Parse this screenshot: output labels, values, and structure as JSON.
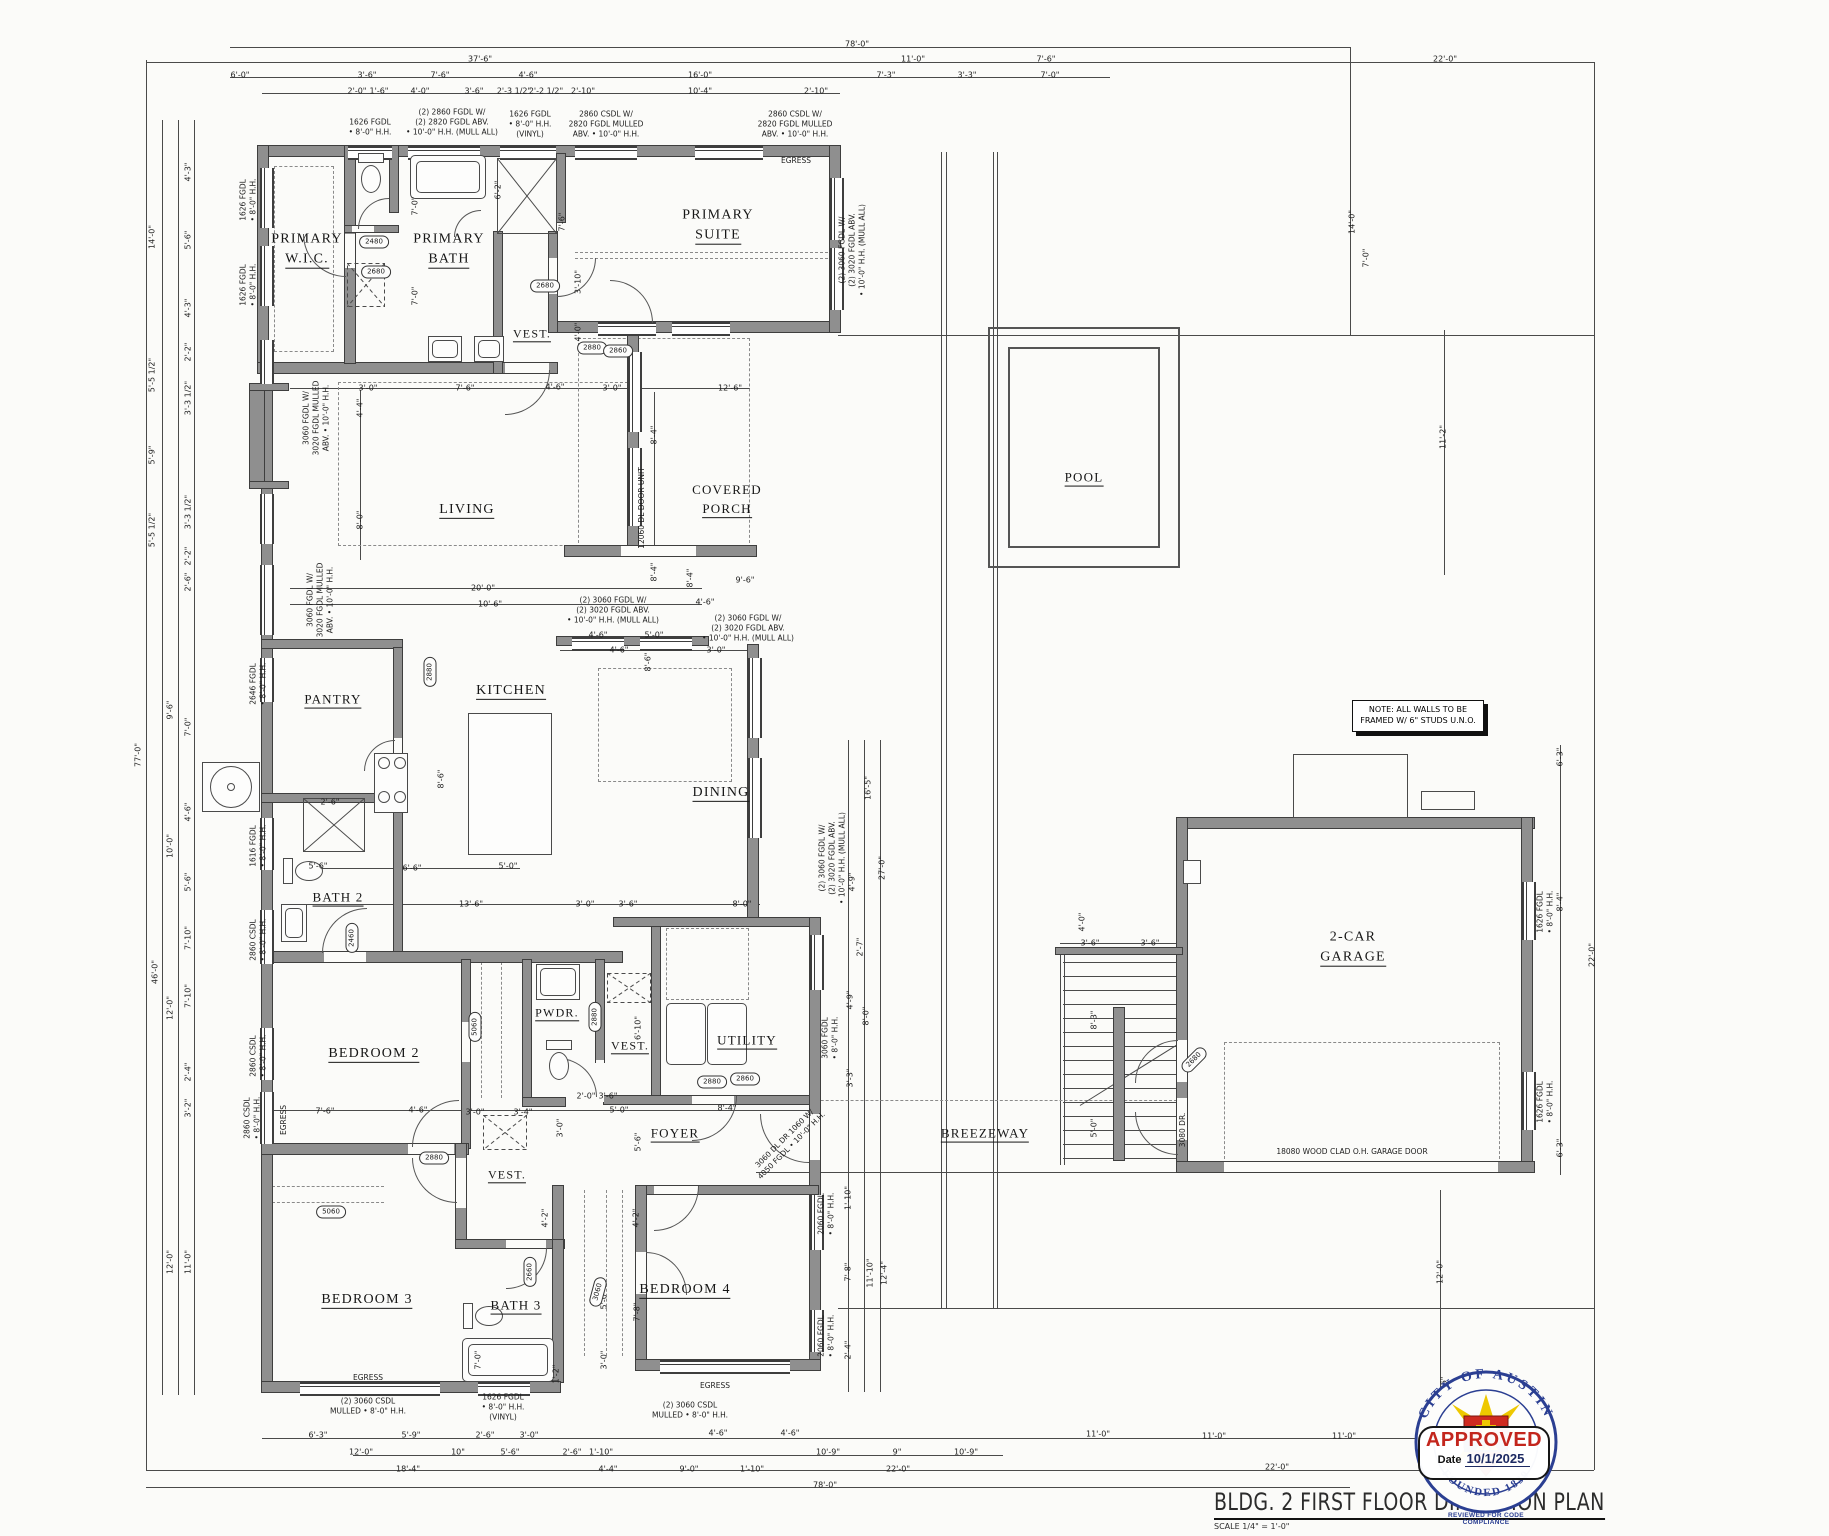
{
  "title_block": {
    "title": "BLDG. 2 FIRST FLOOR DIMENSION PLAN",
    "scale": "SCALE 1/4\" = 1'-0\""
  },
  "stamp": {
    "seal_top": "CITY OF AUSTIN",
    "seal_bottom": "FOUNDED 1839",
    "approved": "APPROVED",
    "date_label": "Date",
    "date": "10/1/2025",
    "reviewed": "REVIEWED FOR CODE COMPLIANCE"
  },
  "note": "NOTE: ALL WALLS TO BE\nFRAMED W/ 6\" STUDS U.N.O.",
  "colors": {
    "wall_gray": "#8f8f8f",
    "approved_red": "#c3261d",
    "seal_blue": "#2b3f92",
    "seal_yellow": "#eec800",
    "seal_red": "#cf2a20"
  },
  "rooms": [
    {
      "id": "primary-wic",
      "lines": [
        "PRIMARY",
        "W.I.C."
      ],
      "x": 307,
      "y": 250,
      "s": 14
    },
    {
      "id": "primary-bath",
      "lines": [
        "PRIMARY",
        "BATH"
      ],
      "x": 449,
      "y": 250,
      "s": 14
    },
    {
      "id": "vest-1",
      "lines": [
        "VEST."
      ],
      "x": 532,
      "y": 334,
      "s": 12
    },
    {
      "id": "primary-suite",
      "lines": [
        "PRIMARY",
        "SUITE"
      ],
      "x": 718,
      "y": 226,
      "s": 14
    },
    {
      "id": "living",
      "lines": [
        "LIVING"
      ],
      "x": 467,
      "y": 510,
      "s": 14
    },
    {
      "id": "covered-porch",
      "lines": [
        "COVERED",
        "PORCH"
      ],
      "x": 727,
      "y": 500,
      "s": 13
    },
    {
      "id": "pool",
      "lines": [
        "POOL"
      ],
      "x": 1084,
      "y": 478,
      "s": 13
    },
    {
      "id": "pantry",
      "lines": [
        "PANTRY"
      ],
      "x": 333,
      "y": 700,
      "s": 13
    },
    {
      "id": "kitchen",
      "lines": [
        "KITCHEN"
      ],
      "x": 511,
      "y": 691,
      "s": 14
    },
    {
      "id": "dining",
      "lines": [
        "DINING"
      ],
      "x": 721,
      "y": 793,
      "s": 14
    },
    {
      "id": "bath-2",
      "lines": [
        "BATH 2"
      ],
      "x": 338,
      "y": 898,
      "s": 13
    },
    {
      "id": "bedroom-2",
      "lines": [
        "BEDROOM 2"
      ],
      "x": 374,
      "y": 1054,
      "s": 14
    },
    {
      "id": "pwdr",
      "lines": [
        "PWDR."
      ],
      "x": 557,
      "y": 1013,
      "s": 12
    },
    {
      "id": "vest-2",
      "lines": [
        "VEST."
      ],
      "x": 630,
      "y": 1046,
      "s": 12
    },
    {
      "id": "utility",
      "lines": [
        "UTILITY"
      ],
      "x": 747,
      "y": 1041,
      "s": 13
    },
    {
      "id": "foyer",
      "lines": [
        "FOYER"
      ],
      "x": 675,
      "y": 1134,
      "s": 13
    },
    {
      "id": "breezeway",
      "lines": [
        "BREEZEWAY"
      ],
      "x": 985,
      "y": 1134,
      "s": 13
    },
    {
      "id": "garage",
      "lines": [
        "2-CAR",
        "GARAGE"
      ],
      "x": 1353,
      "y": 948,
      "s": 14
    },
    {
      "id": "vest-3",
      "lines": [
        "VEST."
      ],
      "x": 507,
      "y": 1175,
      "s": 12
    },
    {
      "id": "bath-3",
      "lines": [
        "BATH 3"
      ],
      "x": 516,
      "y": 1306,
      "s": 13
    },
    {
      "id": "bedroom-3",
      "lines": [
        "BEDROOM 3"
      ],
      "x": 367,
      "y": 1300,
      "s": 14
    },
    {
      "id": "bedroom-4",
      "lines": [
        "BEDROOM 4"
      ],
      "x": 685,
      "y": 1290,
      "s": 14
    }
  ],
  "dims": [
    [
      "78'-0\"",
      857,
      44
    ],
    [
      "37'-6\"",
      480,
      59
    ],
    [
      "11'-0\"",
      913,
      59
    ],
    [
      "7'-6\"",
      1046,
      59
    ],
    [
      "22'-0\"",
      1445,
      59
    ],
    [
      "6'-0\"",
      240,
      75
    ],
    [
      "3'-6\"",
      367,
      75
    ],
    [
      "7'-6\"",
      440,
      75
    ],
    [
      "4'-6\"",
      528,
      75
    ],
    [
      "16'-0\"",
      700,
      75
    ],
    [
      "7'-3\"",
      886,
      75
    ],
    [
      "3'-3\"",
      967,
      75
    ],
    [
      "7'-0\"",
      1050,
      75
    ],
    [
      "2'-0\"",
      357,
      91
    ],
    [
      "1'-6\"",
      379,
      91
    ],
    [
      "4'-0\"",
      420,
      91
    ],
    [
      "3'-6\"",
      474,
      91
    ],
    [
      "2'-3 1/2\"",
      514,
      91
    ],
    [
      "2'-2 1/2\"",
      546,
      91
    ],
    [
      "2'-10\"",
      583,
      91
    ],
    [
      "10'-4\"",
      700,
      91
    ],
    [
      "2'-10\"",
      816,
      91
    ],
    [
      "14'-0\"",
      152,
      237,
      -90
    ],
    [
      "4'-3\"",
      188,
      172,
      -90
    ],
    [
      "5'-6\"",
      188,
      240,
      -90
    ],
    [
      "4'-3\"",
      188,
      308,
      -90
    ],
    [
      "2'-2\"",
      188,
      352,
      -90
    ],
    [
      "5'-5 1/2\"",
      152,
      375,
      -90
    ],
    [
      "3'-3 1/2\"",
      188,
      398,
      -90
    ],
    [
      "5'-9\"",
      152,
      455,
      -90
    ],
    [
      "3'-3 1/2\"",
      188,
      512,
      -90
    ],
    [
      "5'-5 1/2\"",
      152,
      530,
      -90
    ],
    [
      "2'-2\"",
      188,
      556,
      -90
    ],
    [
      "2'-6\"",
      188,
      582,
      -90
    ],
    [
      "77'-0\"",
      138,
      755,
      -90
    ],
    [
      "9'-6\"",
      170,
      710,
      -90
    ],
    [
      "7'-0\"",
      188,
      727,
      -90
    ],
    [
      "4'-6\"",
      188,
      812,
      -90
    ],
    [
      "10'-0\"",
      170,
      846,
      -90
    ],
    [
      "5'-6\"",
      188,
      882,
      -90
    ],
    [
      "46'-0\"",
      155,
      972,
      -90
    ],
    [
      "7'-10\"",
      188,
      938,
      -90
    ],
    [
      "12'-0\"",
      170,
      1008,
      -90
    ],
    [
      "7'-10\"",
      188,
      996,
      -90
    ],
    [
      "2'-4\"",
      188,
      1072,
      -90
    ],
    [
      "3'-2\"",
      188,
      1108,
      -90
    ],
    [
      "12'-0\"",
      170,
      1262,
      -90
    ],
    [
      "11'-0\"",
      188,
      1262,
      -90
    ],
    [
      "14'-0\"",
      1352,
      222,
      -90
    ],
    [
      "7'-0\"",
      1366,
      258,
      -90
    ],
    [
      "11'-2\"",
      1443,
      437,
      -90
    ],
    [
      "7'-0\"",
      415,
      206,
      -90
    ],
    [
      "6'-2\"",
      498,
      190,
      -90
    ],
    [
      "7'-0\"",
      415,
      296,
      -90
    ],
    [
      "3'-10\"",
      578,
      282,
      -90
    ],
    [
      "4'-0\"",
      578,
      332,
      -90
    ],
    [
      "7'-6\"",
      562,
      222,
      -90
    ],
    [
      "3'-0\"",
      368,
      388
    ],
    [
      "7'-6\"",
      465,
      388
    ],
    [
      "4'-6\"",
      555,
      387
    ],
    [
      "3'-0\"",
      612,
      388
    ],
    [
      "12'-6\"",
      730,
      388
    ],
    [
      "4'-4\"",
      360,
      408,
      -90
    ],
    [
      "8'-0\"",
      360,
      520,
      -90
    ],
    [
      "8'-4\"",
      654,
      435,
      -90
    ],
    [
      "8'-4\"",
      654,
      572,
      -90
    ],
    [
      "20'-0\"",
      483,
      588
    ],
    [
      "10'-6\"",
      490,
      604
    ],
    [
      "9'-6\"",
      745,
      580
    ],
    [
      "4'-6\"",
      705,
      602
    ],
    [
      "8'-4\"",
      690,
      578,
      -90
    ],
    [
      "4'-6\"",
      598,
      635
    ],
    [
      "5'-0\"",
      654,
      635
    ],
    [
      "4'-6\"",
      619,
      650
    ],
    [
      "3'-0\"",
      716,
      650
    ],
    [
      "8'-6\"",
      648,
      662,
      -90
    ],
    [
      "8'-6\"",
      441,
      779,
      -90
    ],
    [
      "6'-6\"",
      412,
      868
    ],
    [
      "5'-0\"",
      508,
      866
    ],
    [
      "13'-6\"",
      471,
      904
    ],
    [
      "3'-0\"",
      585,
      904
    ],
    [
      "3'-6\"",
      628,
      904
    ],
    [
      "8'-0\"",
      742,
      904
    ],
    [
      "2'-6\"",
      330,
      802
    ],
    [
      "5'-6\"",
      318,
      866
    ],
    [
      "16'-5\"",
      868,
      788,
      -90
    ],
    [
      "27'-0\"",
      882,
      868,
      -90
    ],
    [
      "4'-9\"",
      852,
      882,
      -90
    ],
    [
      "2'-7\"",
      860,
      947,
      -90
    ],
    [
      "4'-9\"",
      850,
      1000,
      -90
    ],
    [
      "8'-0\"",
      866,
      1016,
      -90
    ],
    [
      "3'-3\"",
      850,
      1078,
      -90
    ],
    [
      "6'-10\"",
      638,
      1028,
      -90
    ],
    [
      "3'-0\"",
      560,
      1128,
      -90
    ],
    [
      "5'-6\"",
      638,
      1142,
      -90
    ],
    [
      "2'-0\"",
      586,
      1096
    ],
    [
      "3'-6\"",
      608,
      1096
    ],
    [
      "5'-0\"",
      619,
      1110
    ],
    [
      "8'-4\"",
      727,
      1108
    ],
    [
      "7'-6\"",
      325,
      1111
    ],
    [
      "4'-6\"",
      418,
      1110
    ],
    [
      "3'-0\"",
      475,
      1112
    ],
    [
      "3'-4\"",
      523,
      1112
    ],
    [
      "4'-2\"",
      545,
      1218,
      -90
    ],
    [
      "4'-2\"",
      636,
      1218,
      -90
    ],
    [
      "5'-0\"",
      604,
      1300,
      -90
    ],
    [
      "3'-0\"",
      604,
      1360,
      -90
    ],
    [
      "7'-0\"",
      478,
      1360,
      -90
    ],
    [
      "7'-8\"",
      637,
      1312,
      -90
    ],
    [
      "1'-2\"",
      556,
      1374,
      -90
    ],
    [
      "1'-10\"",
      848,
      1198,
      -90
    ],
    [
      "7'-8\"",
      848,
      1272,
      -90
    ],
    [
      "2'-4\"",
      848,
      1350,
      -90
    ],
    [
      "11'-10\"",
      870,
      1273,
      -90
    ],
    [
      "12'-4\"",
      884,
      1273,
      -90
    ],
    [
      "4'-0\"",
      1082,
      922,
      -90
    ],
    [
      "3'-6\"",
      1090,
      943
    ],
    [
      "3'-6\"",
      1150,
      943
    ],
    [
      "8'-3\"",
      1094,
      1020,
      -90
    ],
    [
      "5'-0\"",
      1094,
      1128,
      -90
    ],
    [
      "6'-3\"",
      1560,
      757,
      -90
    ],
    [
      "8'-4\"",
      1560,
      902,
      -90
    ],
    [
      "6'-3\"",
      1560,
      1148,
      -90
    ],
    [
      "22'-0\"",
      1592,
      955,
      -90
    ],
    [
      "12'-0\"",
      1440,
      1272,
      -90
    ],
    [
      "1'-6\"",
      1444,
      1386,
      -90
    ],
    [
      "6'-3\"",
      318,
      1435
    ],
    [
      "5'-9\"",
      411,
      1435
    ],
    [
      "2'-6\"",
      485,
      1435
    ],
    [
      "3'-0\"",
      529,
      1435
    ],
    [
      "4'-6\"",
      718,
      1433
    ],
    [
      "4'-6\"",
      790,
      1433
    ],
    [
      "11'-0\"",
      1098,
      1434
    ],
    [
      "11'-0\"",
      1214,
      1436
    ],
    [
      "11'-0\"",
      1344,
      1436
    ],
    [
      "12'-0\"",
      361,
      1452
    ],
    [
      "10\"",
      458,
      1452
    ],
    [
      "5'-6\"",
      510,
      1452
    ],
    [
      "2'-6\"",
      572,
      1452
    ],
    [
      "1'-10\"",
      601,
      1452
    ],
    [
      "10'-9\"",
      828,
      1452
    ],
    [
      "9\"",
      897,
      1452
    ],
    [
      "10'-9\"",
      966,
      1452
    ],
    [
      "18'-4\"",
      408,
      1469
    ],
    [
      "4'-4\"",
      608,
      1469
    ],
    [
      "9'-0\"",
      689,
      1469
    ],
    [
      "1'-10\"",
      752,
      1469
    ],
    [
      "22'-0\"",
      898,
      1469
    ],
    [
      "22'-0\"",
      1277,
      1467
    ],
    [
      "78'-0\"",
      825,
      1485
    ]
  ],
  "specs": [
    [
      "1626 FGDL\n• 8'-0\" H.H.",
      370,
      127
    ],
    [
      "(2) 2860 FGDL W/\n(2) 2820 FGDL ABV.\n• 10'-0\" H.H. (MULL ALL)",
      452,
      122
    ],
    [
      "1626 FGDL\n• 8'-0\" H.H.\n(VINYL)",
      530,
      124
    ],
    [
      "2860 CSDL W/\n2820 FGDL MULLED\nABV. • 10'-0\" H.H.",
      606,
      124
    ],
    [
      "2860 CSDL W/\n2820 FGDL MULLED\nABV. • 10'-0\" H.H.",
      795,
      124
    ],
    [
      "EGRESS",
      796,
      161
    ],
    [
      "1626 FGDL\n• 8'-0\" H.H.",
      248,
      200,
      -90
    ],
    [
      "1626 FGDL\n• 8'-0\" H.H.",
      248,
      285,
      -90
    ],
    [
      "3060 FGDL W/\n3020 FGDL MULLED\nABV. • 10'-0\" H.H.",
      316,
      418,
      -90
    ],
    [
      "3060 FGDL W/\n3020 FGDL MULLED\nABV. • 10'-0\" H.H.",
      320,
      600,
      -90
    ],
    [
      "2646 FGDL\n• 8'-0\" H.H.",
      258,
      684,
      -90
    ],
    [
      "1616 FGDL\n• 8'-0\" H.H.",
      258,
      846,
      -90
    ],
    [
      "2860 CSDL\n• 8'-0\" H.H.",
      258,
      940,
      -90
    ],
    [
      "2860 CSDL\n• 8'-0\" H.H.",
      258,
      1056,
      -90
    ],
    [
      "2860 CSDL\n• 8'-0\" H.H.",
      252,
      1118,
      -90
    ],
    [
      "EGRESS",
      284,
      1120,
      -90
    ],
    [
      "(2) 3060 FGDL W/\n(2) 3020 FGDL ABV.\n• 10'-0\" H.H. (MULL ALL)",
      852,
      250,
      -90
    ],
    [
      "12060 DL DOOR UNIT",
      642,
      508,
      -90
    ],
    [
      "(2) 3060 FGDL W/\n(2) 3020 FGDL ABV.\n• 10'-0\" H.H. (MULL ALL)",
      613,
      610
    ],
    [
      "(2) 3060 FGDL W/\n(2) 3020 FGDL ABV.\n• 10'-0\" H.H. (MULL ALL)",
      748,
      628
    ],
    [
      "(2) 3060 FGDL W/\n(2) 3020 FGDL ABV.\n• 10'-0\" H.H. (MULL ALL)",
      832,
      858,
      -90
    ],
    [
      "3060 FGDL\n• 8'-0\" H.H.",
      830,
      1038,
      -90
    ],
    [
      "3060 DL DR 1060 W/\n4050 FGDL • 10'-0\" H.H.",
      788,
      1142,
      -45
    ],
    [
      "3080 DR.",
      1183,
      1130,
      -90
    ],
    [
      "1626 FGDL\n• 8'-0\" H.H.",
      1545,
      912,
      -90
    ],
    [
      "1626 FGDL\n• 8'-0\" H.H.",
      1545,
      1102,
      -90
    ],
    [
      "2060 FGDL\n• 8'-0\" H.H.",
      826,
      1214,
      -90
    ],
    [
      "2060 FGDL\n• 8'-0\" H.H.",
      826,
      1336,
      -90
    ],
    [
      "(2) 3060 CSDL\nMULLED • 8'-0\" H.H.",
      368,
      1406
    ],
    [
      "1626 FGDL\n• 8'-0\" H.H.\n(VINYL)",
      503,
      1407
    ],
    [
      "(2) 3060 CSDL\nMULLED • 8'-0\" H.H.",
      690,
      1410
    ],
    [
      "EGRESS",
      368,
      1378
    ],
    [
      "EGRESS",
      715,
      1386
    ],
    [
      "18080 WOOD CLAD O.H. GARAGE DOOR",
      1352,
      1152
    ]
  ],
  "door_tags": [
    [
      "2480",
      374,
      242
    ],
    [
      "2680",
      376,
      272
    ],
    [
      "2680",
      545,
      286
    ],
    [
      "2880",
      592,
      348
    ],
    [
      "2860",
      618,
      351
    ],
    [
      "2880",
      430,
      672,
      -90
    ],
    [
      "2460",
      352,
      938,
      -90
    ],
    [
      "5060",
      475,
      1027,
      -90
    ],
    [
      "2880",
      595,
      1017,
      -90
    ],
    [
      "2860",
      745,
      1079
    ],
    [
      "2680",
      1194,
      1060,
      -45
    ],
    [
      "2880",
      434,
      1158
    ],
    [
      "2880",
      712,
      1082
    ],
    [
      "5060",
      331,
      1212
    ],
    [
      "2660",
      530,
      1272,
      -90
    ],
    [
      "3060",
      598,
      1292,
      -75
    ]
  ]
}
